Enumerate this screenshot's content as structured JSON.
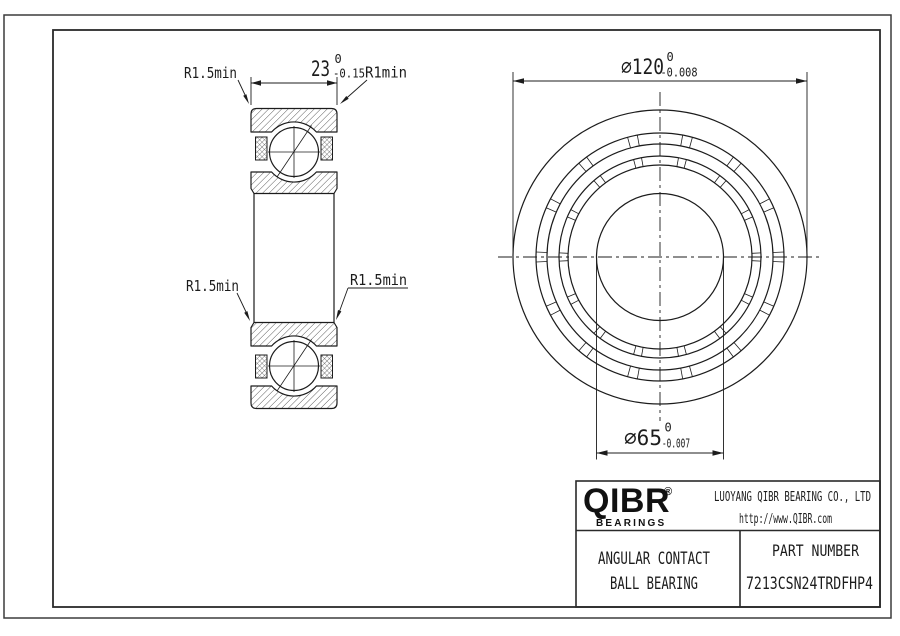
{
  "colors": {
    "line": "#1c1c1c",
    "background": "#ffffff"
  },
  "section_view": {
    "width_dim": {
      "value": "23",
      "tol_upper": "0",
      "tol_lower": "-0.15"
    },
    "radius_top_left": "R1.5min",
    "radius_top_right": "R1min",
    "radius_mid_left": "R1.5min",
    "radius_mid_right": "R1.5min"
  },
  "front_view": {
    "outer_dia_dim": {
      "value": "∅120",
      "tol_upper": "0",
      "tol_lower": "-0.008"
    },
    "bore_dia_dim": {
      "value": "∅65",
      "tol_upper": "0",
      "tol_lower": "-0.007"
    }
  },
  "title_block": {
    "brand": {
      "name": "QIBR",
      "registered": "®",
      "tagline": "BEARINGS"
    },
    "company": "LUOYANG QIBR BEARING CO., LTD",
    "website": "http://www.QIBR.com",
    "product": {
      "line1": "ANGULAR CONTACT",
      "line2": "BALL BEARING"
    },
    "part_number_label": "PART NUMBER",
    "part_number": "7213CSN24TRDFHP4"
  }
}
